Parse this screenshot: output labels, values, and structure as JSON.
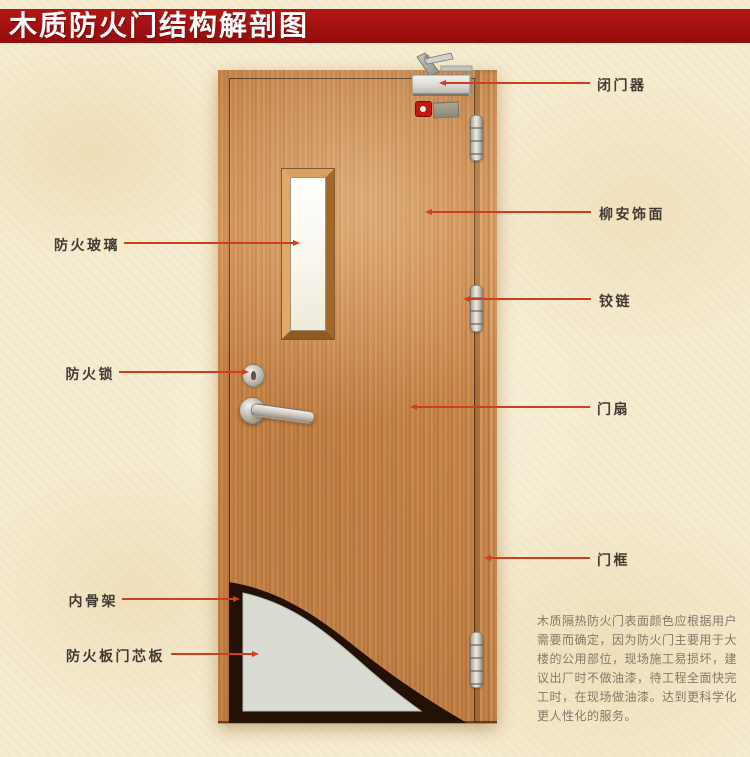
{
  "title": "木质防火门结构解剖图",
  "diagram": {
    "left_labels": [
      {
        "text": "防火玻璃"
      },
      {
        "text": "防火锁"
      },
      {
        "text": "内骨架"
      },
      {
        "text": "防火板门芯板"
      }
    ],
    "right_labels": [
      {
        "text": "闭门器"
      },
      {
        "text": "柳安饰面"
      },
      {
        "text": "铰链"
      },
      {
        "text": "门扇"
      },
      {
        "text": "门框"
      }
    ],
    "description": "木质隔热防火门表面颜色应根据用户\n需要而确定，因为防火门主要用于大\n楼的公用部位，现场施工易损坏，建\n议出厂时不做油漆，待工程全面快完\n工时，在现场做油漆。达到更科学化\n更人性化的服务。"
  },
  "colors": {
    "banner": "#a11110",
    "leader_line": "#cf3f1d",
    "background": "#f6ecd1",
    "door_wood": "#c9854a",
    "core_panel": "#dadcd3",
    "inner_skeleton": "#241106"
  }
}
